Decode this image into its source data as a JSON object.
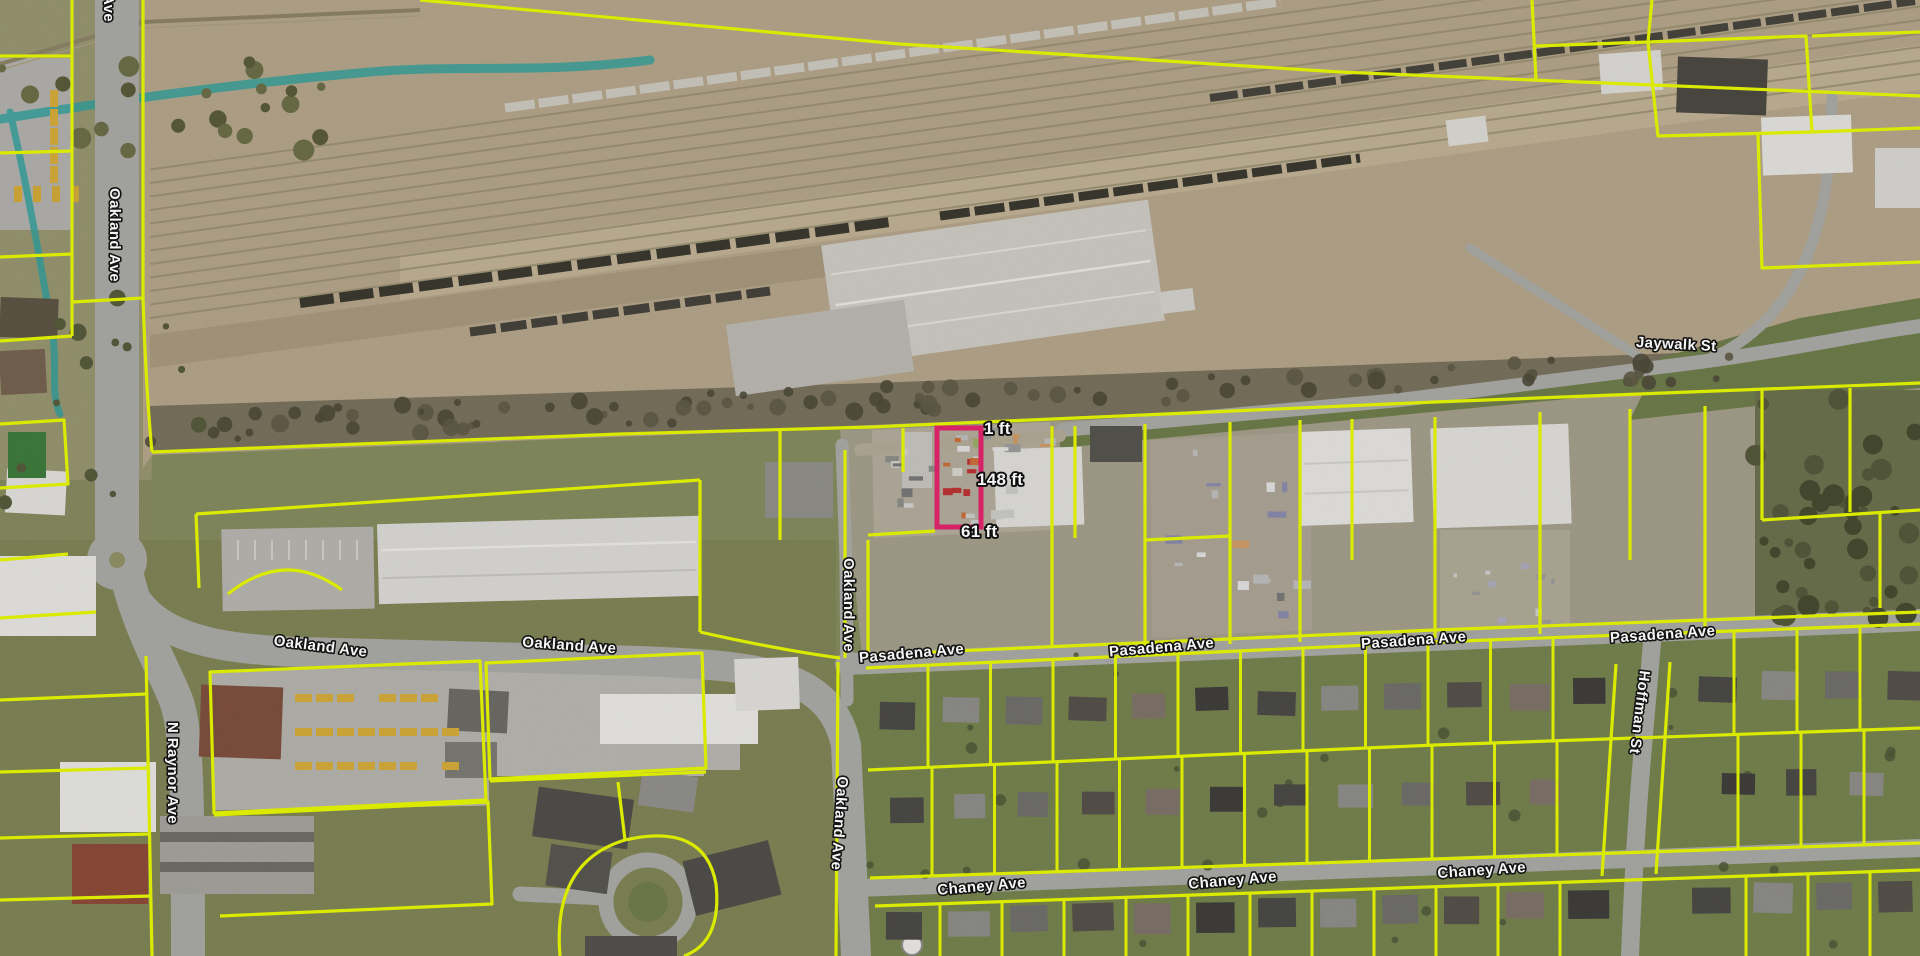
{
  "colors": {
    "parcel_line": "#e3f400",
    "selected_parcel": "#e0246b",
    "stream": "#2f9e9a",
    "road": "#a7a7a3",
    "rail_yard": "#b2a389",
    "grass": "#76814e",
    "label_fill": "#ffffff",
    "label_halo": "#141414"
  },
  "measurements": [
    {
      "side": "top",
      "text": "1 ft"
    },
    {
      "side": "right",
      "text": "148 ft"
    },
    {
      "side": "bottom",
      "text": "61 ft"
    }
  ],
  "streets": [
    {
      "id": "oakland-ave-partial-top",
      "text": "Ave"
    },
    {
      "id": "oakland-ave-north",
      "text": "Oakland Ave"
    },
    {
      "id": "oakland-ave-west-1",
      "text": "Oakland Ave"
    },
    {
      "id": "oakland-ave-west-2",
      "text": "Oakland Ave"
    },
    {
      "id": "oakland-ave-center-north",
      "text": "Oakland Ave"
    },
    {
      "id": "oakland-ave-center-south",
      "text": "Oakland Ave"
    },
    {
      "id": "n-raynor-ave",
      "text": "N Raynor Ave"
    },
    {
      "id": "jaywalk-st",
      "text": "Jaywalk St"
    },
    {
      "id": "pasadena-ave-1",
      "text": "Pasadena Ave"
    },
    {
      "id": "pasadena-ave-2",
      "text": "Pasadena Ave"
    },
    {
      "id": "pasadena-ave-3",
      "text": "Pasadena Ave"
    },
    {
      "id": "pasadena-ave-4",
      "text": "Pasadena Ave"
    },
    {
      "id": "hoffman-st",
      "text": "Hoffman St"
    },
    {
      "id": "chaney-ave-1",
      "text": "Chaney Ave"
    },
    {
      "id": "chaney-ave-2",
      "text": "Chaney Ave"
    },
    {
      "id": "chaney-ave-3",
      "text": "Chaney Ave"
    }
  ]
}
